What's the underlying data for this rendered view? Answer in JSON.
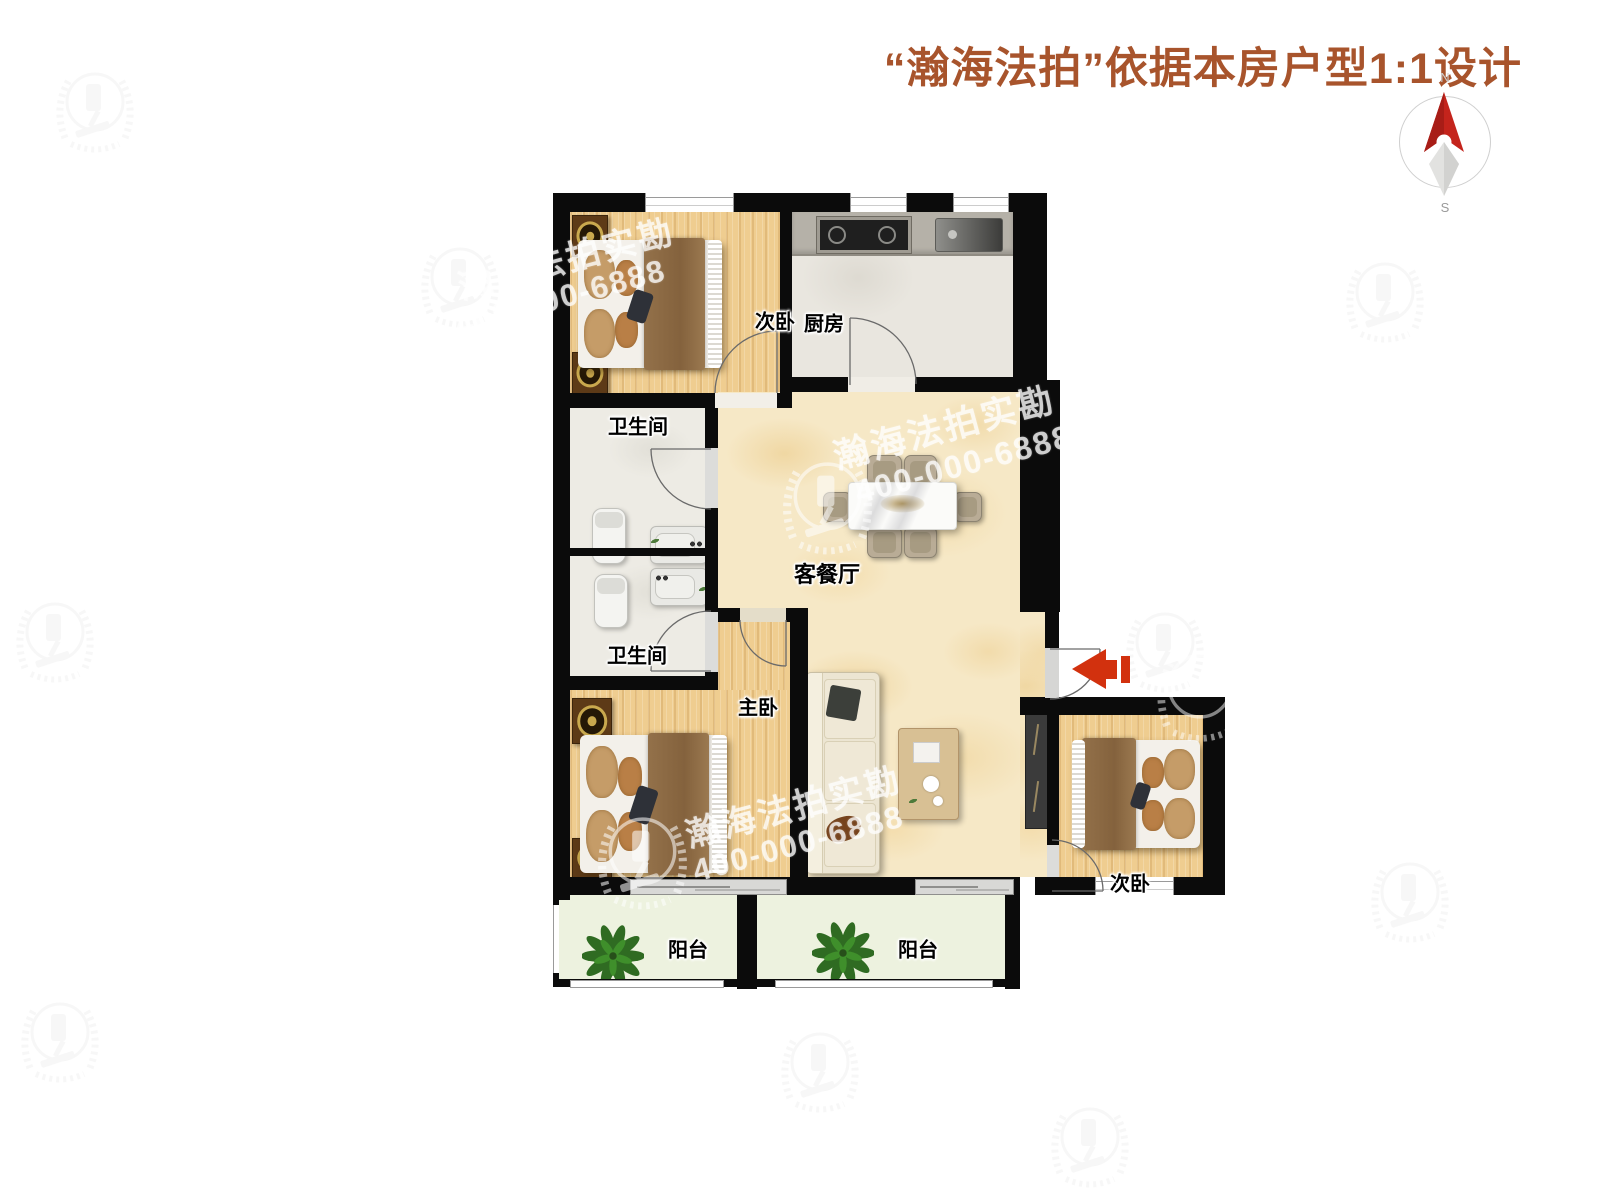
{
  "header": {
    "title": "“瀚海法拍”依据本房户型1:1设计",
    "color": "#a8542c"
  },
  "compass": {
    "north": "N",
    "south": "S"
  },
  "rooms": {
    "bedroom_top": "次卧",
    "kitchen": "厨房",
    "bath_upper": "卫生间",
    "bath_lower": "卫生间",
    "living": "客餐厅",
    "master": "主卧",
    "bedroom_right": "次卧",
    "balcony_left": "阳台",
    "balcony_right": "阳台"
  },
  "watermark": {
    "brand": "瀚海法拍实勘",
    "phone": "400-000-6888"
  },
  "entry": {
    "arrow_color": "#d2310e"
  },
  "colors": {
    "wall": "#0b0b0b",
    "wood_floor": "#efcd90",
    "living_floor": "#f6e8c6",
    "kitchen_floor": "#e9e6df",
    "bath_floor": "#edebe4",
    "balcony_floor": "#edf2df",
    "header_text": "#a8542c"
  }
}
